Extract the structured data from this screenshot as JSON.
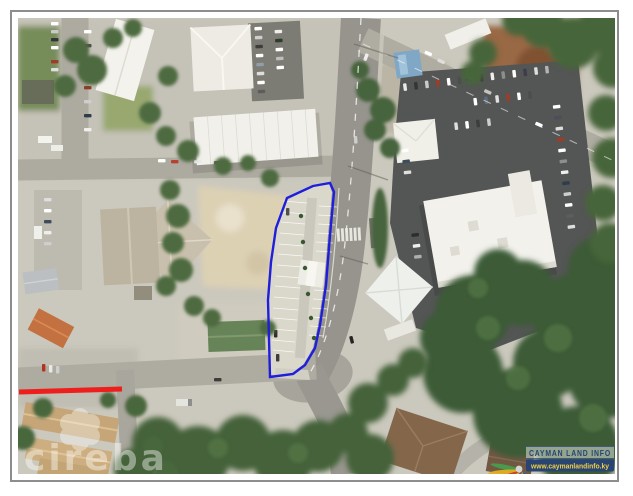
{
  "frame": {
    "border_color": "#8d8d8d",
    "matte_color": "#ffffff"
  },
  "annotations": {
    "parcel_outline": {
      "color": "#1212dd",
      "stroke_width": 2.4,
      "points": "295,168 312,165 316,174 312,217 308,267 302,307 297,330 287,347 275,356 252,359 250,282 253,244 258,210 269,180"
    },
    "road_highlight": {
      "color": "#ee1212",
      "stroke_width": 5,
      "points": "1,374 104,371"
    }
  },
  "watermarks": {
    "realtor": {
      "text": "cireba",
      "color": "#ffffff",
      "opacity": 0.42
    },
    "provider": {
      "title": "CAYMAN LAND INFO",
      "website": "www.caymanlandinfo.ky",
      "title_color": "#1c3a6d",
      "website_color": "#f2cf3a",
      "bar_color": "#1c3a6d",
      "fan_colors": [
        "#e2ac1c",
        "#c93a22",
        "#2b57a7",
        "#3d9a47"
      ]
    }
  },
  "scene": {
    "colors": {
      "ground": "#c9c6bc",
      "road": "#a29f98",
      "dark_asphalt": "#4b4c4e",
      "vegetation": "#35552e",
      "parcel_concrete": "#d8d5cb",
      "sand": "#dbcfb2",
      "dirt": "#94603c"
    }
  }
}
